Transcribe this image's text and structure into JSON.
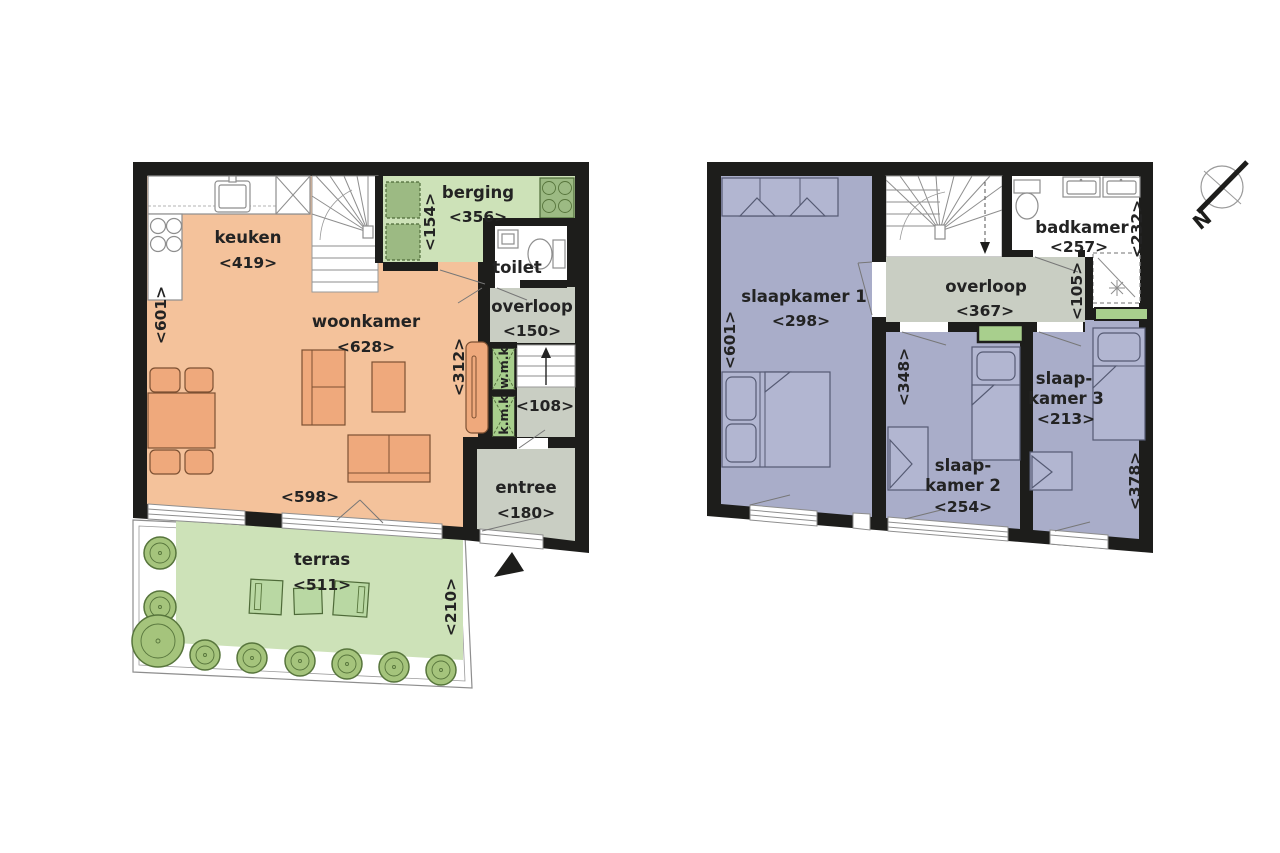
{
  "palette": {
    "wall": "#1d1d1b",
    "living_orange": "#f4c29b",
    "garden_green": "#cde2b8",
    "hall_gray": "#c9cec3",
    "bedroom_purple": "#a9adc9",
    "furniture_orange": "#efa97c",
    "furniture_purple": "#b2b6d1",
    "tree_green": "#a5c47c",
    "meter_green": "#a8cf8d",
    "text": "#232323"
  },
  "compass": {
    "north_label": "N"
  },
  "floor1": {
    "keuken": {
      "name": "keuken",
      "dim": "<419>"
    },
    "woonkamer": {
      "name": "woonkamer",
      "dim": "<628>"
    },
    "berging": {
      "name": "berging",
      "dim": "<356>"
    },
    "toilet": {
      "name": "toilet"
    },
    "overloop": {
      "name": "overloop",
      "dim": "<150>"
    },
    "trap": {
      "dim": "<108>"
    },
    "entree": {
      "name": "entree",
      "dim": "<180>"
    },
    "terras": {
      "name": "terras",
      "dim": "<511>"
    },
    "meterkast_w": "w.m.k",
    "meterkast_k": "k.m.k",
    "dims": {
      "left": "<601>",
      "berging_side": "<154>",
      "wand": "<312>",
      "bottom": "<598>",
      "terras_side": "<210>"
    }
  },
  "floor2": {
    "slaapkamer1": {
      "name": "slaapkamer 1",
      "dim": "<298>"
    },
    "slaapkamer2": {
      "name_line1": "slaap-",
      "name_line2": "kamer 2",
      "dim": "<254>"
    },
    "slaapkamer3": {
      "name_line1": "slaap-",
      "name_line2": "kamer 3",
      "dim": "<213>"
    },
    "badkamer": {
      "name": "badkamer",
      "dim": "<257>"
    },
    "overloop": {
      "name": "overloop",
      "dim": "<367>"
    },
    "dims": {
      "left": "<601>",
      "badkamer_side": "<232>",
      "overloop_side": "<105>",
      "slaapkamer2_side": "<348>",
      "slaapkamer3_side": "<378>"
    }
  }
}
